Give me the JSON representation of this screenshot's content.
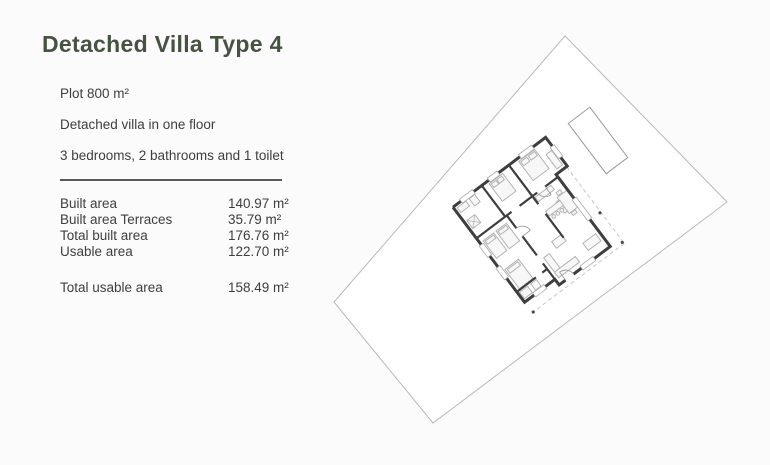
{
  "page": {
    "colors": {
      "bg": "#fbfbfb",
      "accent": "#455340",
      "text": "#3e3e3e",
      "divider": "#585858",
      "plot": "#b9b9b9",
      "wall": "#3e3e3e",
      "furn": "#b3b3b3",
      "dash": "#c6c6c6",
      "pool": "#9a9a9a"
    }
  },
  "header": {
    "title": "Detached Villa Type 4"
  },
  "summary": {
    "lines": [
      "Plot 800 m²",
      "Detached villa in one floor",
      "3 bedrooms, 2 bathrooms and 1 toilet"
    ]
  },
  "areas": {
    "rows": [
      {
        "label": "Built area",
        "value": "140.97 m²"
      },
      {
        "label": "Built area Terraces",
        "value": "35.79 m²"
      },
      {
        "label": "Total built area",
        "value": "176.76 m²"
      },
      {
        "label": "Usable area",
        "value": "122.70 m²"
      }
    ],
    "total": {
      "label": "Total usable area",
      "value": "158.49 m²"
    }
  },
  "site_plan": {
    "description": "Rotated site plan: plot boundary, pool, one-floor villa floor plan with terraces"
  }
}
